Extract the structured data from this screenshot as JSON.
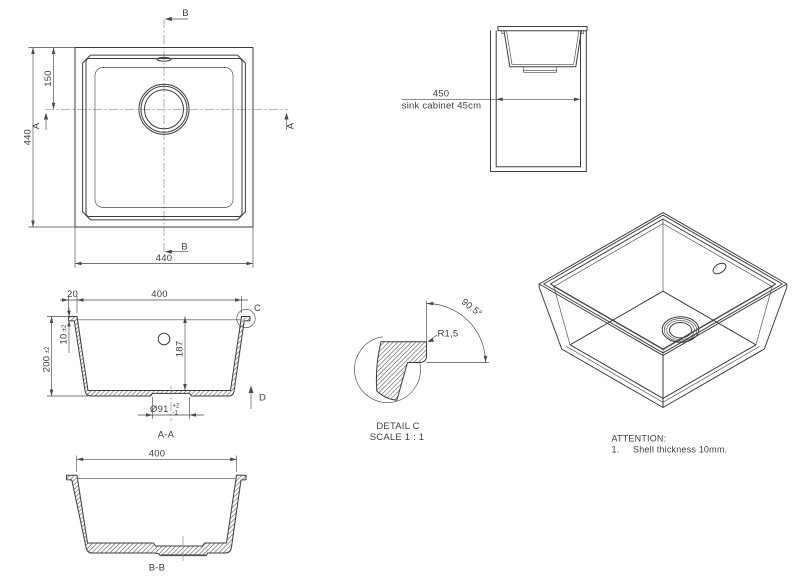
{
  "top_view": {
    "width_label": "440",
    "height_label": "440",
    "drain_offset_label": "150",
    "section_b_top": "B",
    "section_b_bottom": "B",
    "section_a_left": "A",
    "section_a_right": "A"
  },
  "cabinet_view": {
    "width_label": "450",
    "caption": "sink cabinet 45cm"
  },
  "section_aa": {
    "label": "A-A",
    "opening_width_label": "400",
    "rim_width_label": "20",
    "depth_label": "200",
    "depth_tol": "±2",
    "rim_thickness_label": "10",
    "rim_thickness_tol": "±2",
    "inner_depth_label": "187",
    "drain_dia_label": "Ø91",
    "drain_dia_tol_plus": "+2",
    "drain_dia_tol_minus": "-1",
    "detail_marker": "C",
    "direction_marker": "D"
  },
  "detail_c": {
    "title": "DETAIL C",
    "scale_label": "SCALE 1 : 1",
    "radius_label": "R1,5",
    "angle_label": "90.5°"
  },
  "section_bb": {
    "label": "B-B",
    "width_label": "400"
  },
  "attention": {
    "title": "ATTENTION:",
    "item_number": "1.",
    "item_text": "Shell thickness 10mm."
  }
}
